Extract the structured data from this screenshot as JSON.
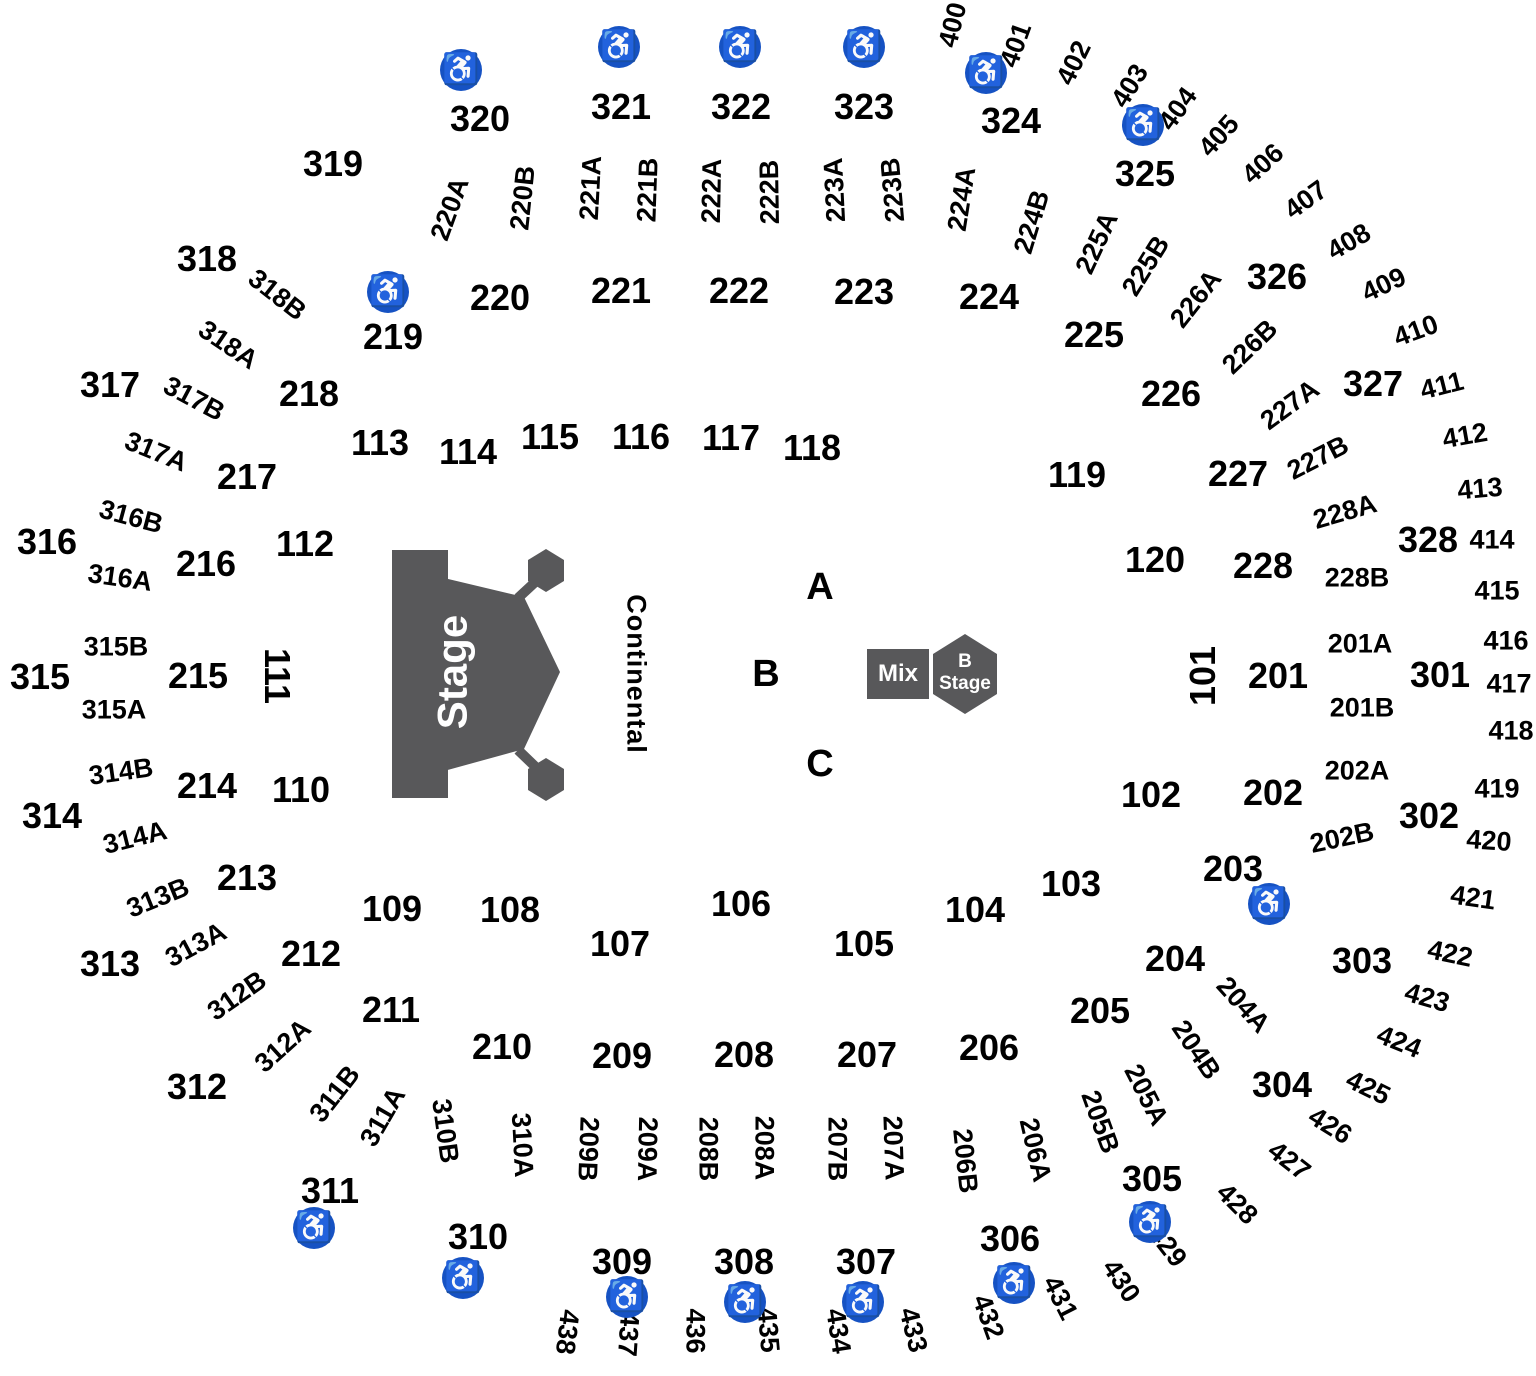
{
  "canvas": {
    "width": 1536,
    "height": 1376,
    "background": "#ffffff"
  },
  "colors": {
    "label_text": "#000000",
    "stage_fill": "#58585a",
    "stage_text": "#ffffff",
    "wheelchair_badge": "#1652c3",
    "wheelchair_glyph": "#ffffff"
  },
  "stage": {
    "label": "Stage"
  },
  "walkway": {
    "label": "Continental"
  },
  "mix_booth": {
    "label": "Mix"
  },
  "b_stage": {
    "line1": "B",
    "line2": "Stage"
  },
  "icons": {
    "wheelchair_glyph": "♿",
    "wheelchair_positions": [
      {
        "x": 461,
        "y": 70
      },
      {
        "x": 619,
        "y": 47
      },
      {
        "x": 740,
        "y": 47
      },
      {
        "x": 864,
        "y": 47
      },
      {
        "x": 986,
        "y": 73
      },
      {
        "x": 1143,
        "y": 125
      },
      {
        "x": 388,
        "y": 292
      },
      {
        "x": 1269,
        "y": 904
      },
      {
        "x": 314,
        "y": 1228
      },
      {
        "x": 463,
        "y": 1278
      },
      {
        "x": 627,
        "y": 1297
      },
      {
        "x": 745,
        "y": 1302
      },
      {
        "x": 863,
        "y": 1302
      },
      {
        "x": 1014,
        "y": 1283
      },
      {
        "x": 1150,
        "y": 1222
      }
    ]
  },
  "labels": {
    "floor_letters": [
      {
        "t": "A",
        "x": 820,
        "y": 587,
        "r": 0
      },
      {
        "t": "B",
        "x": 766,
        "y": 674,
        "r": 0
      },
      {
        "t": "C",
        "x": 820,
        "y": 764,
        "r": 0
      }
    ],
    "main": [
      {
        "t": "101",
        "x": 1203,
        "y": 676,
        "r": -90
      },
      {
        "t": "102",
        "x": 1151,
        "y": 795,
        "r": 0
      },
      {
        "t": "103",
        "x": 1071,
        "y": 884,
        "r": 0
      },
      {
        "t": "104",
        "x": 975,
        "y": 910,
        "r": 0
      },
      {
        "t": "105",
        "x": 864,
        "y": 944,
        "r": 0
      },
      {
        "t": "106",
        "x": 741,
        "y": 904,
        "r": 0
      },
      {
        "t": "107",
        "x": 620,
        "y": 944,
        "r": 0
      },
      {
        "t": "108",
        "x": 510,
        "y": 910,
        "r": 0
      },
      {
        "t": "109",
        "x": 392,
        "y": 909,
        "r": 0
      },
      {
        "t": "110",
        "x": 301,
        "y": 790,
        "r": 0
      },
      {
        "t": "111",
        "x": 277,
        "y": 676,
        "r": 90
      },
      {
        "t": "112",
        "x": 305,
        "y": 544,
        "r": 0
      },
      {
        "t": "113",
        "x": 380,
        "y": 443,
        "r": 0
      },
      {
        "t": "114",
        "x": 468,
        "y": 452,
        "r": 0
      },
      {
        "t": "115",
        "x": 550,
        "y": 437,
        "r": 0
      },
      {
        "t": "116",
        "x": 641,
        "y": 437,
        "r": 0
      },
      {
        "t": "117",
        "x": 731,
        "y": 438,
        "r": 0
      },
      {
        "t": "118",
        "x": 812,
        "y": 448,
        "r": 0
      },
      {
        "t": "119",
        "x": 1077,
        "y": 475,
        "r": 0
      },
      {
        "t": "120",
        "x": 1155,
        "y": 560,
        "r": 0
      },
      {
        "t": "201",
        "x": 1278,
        "y": 676,
        "r": 0
      },
      {
        "t": "202",
        "x": 1273,
        "y": 793,
        "r": 0
      },
      {
        "t": "203",
        "x": 1233,
        "y": 869,
        "r": 0
      },
      {
        "t": "204",
        "x": 1175,
        "y": 959,
        "r": 0
      },
      {
        "t": "205",
        "x": 1100,
        "y": 1011,
        "r": 0
      },
      {
        "t": "206",
        "x": 989,
        "y": 1048,
        "r": 0
      },
      {
        "t": "207",
        "x": 867,
        "y": 1055,
        "r": 0
      },
      {
        "t": "208",
        "x": 744,
        "y": 1055,
        "r": 0
      },
      {
        "t": "209",
        "x": 622,
        "y": 1056,
        "r": 0
      },
      {
        "t": "210",
        "x": 502,
        "y": 1047,
        "r": 0
      },
      {
        "t": "211",
        "x": 391,
        "y": 1010,
        "r": 0
      },
      {
        "t": "212",
        "x": 311,
        "y": 954,
        "r": 0
      },
      {
        "t": "213",
        "x": 247,
        "y": 878,
        "r": 0
      },
      {
        "t": "214",
        "x": 207,
        "y": 786,
        "r": 0
      },
      {
        "t": "215",
        "x": 198,
        "y": 676,
        "r": 0
      },
      {
        "t": "216",
        "x": 206,
        "y": 564,
        "r": 0
      },
      {
        "t": "217",
        "x": 247,
        "y": 477,
        "r": 0
      },
      {
        "t": "218",
        "x": 309,
        "y": 394,
        "r": 0
      },
      {
        "t": "219",
        "x": 393,
        "y": 337,
        "r": 0
      },
      {
        "t": "220",
        "x": 500,
        "y": 298,
        "r": 0
      },
      {
        "t": "221",
        "x": 621,
        "y": 291,
        "r": 0
      },
      {
        "t": "222",
        "x": 739,
        "y": 291,
        "r": 0
      },
      {
        "t": "223",
        "x": 864,
        "y": 292,
        "r": 0
      },
      {
        "t": "224",
        "x": 989,
        "y": 297,
        "r": 0
      },
      {
        "t": "225",
        "x": 1094,
        "y": 335,
        "r": 0
      },
      {
        "t": "226",
        "x": 1171,
        "y": 394,
        "r": 0
      },
      {
        "t": "227",
        "x": 1238,
        "y": 474,
        "r": 0
      },
      {
        "t": "228",
        "x": 1263,
        "y": 566,
        "r": 0
      },
      {
        "t": "301",
        "x": 1440,
        "y": 675,
        "r": 0
      },
      {
        "t": "302",
        "x": 1429,
        "y": 816,
        "r": 0
      },
      {
        "t": "303",
        "x": 1362,
        "y": 961,
        "r": 0
      },
      {
        "t": "304",
        "x": 1282,
        "y": 1085,
        "r": 0
      },
      {
        "t": "305",
        "x": 1152,
        "y": 1179,
        "r": 0
      },
      {
        "t": "306",
        "x": 1010,
        "y": 1239,
        "r": 0
      },
      {
        "t": "307",
        "x": 866,
        "y": 1262,
        "r": 0
      },
      {
        "t": "308",
        "x": 744,
        "y": 1262,
        "r": 0
      },
      {
        "t": "309",
        "x": 622,
        "y": 1262,
        "r": 0
      },
      {
        "t": "310",
        "x": 478,
        "y": 1237,
        "r": 0
      },
      {
        "t": "311",
        "x": 330,
        "y": 1191,
        "r": 0
      },
      {
        "t": "312",
        "x": 197,
        "y": 1087,
        "r": 0
      },
      {
        "t": "313",
        "x": 110,
        "y": 964,
        "r": 0
      },
      {
        "t": "314",
        "x": 52,
        "y": 816,
        "r": 0
      },
      {
        "t": "315",
        "x": 40,
        "y": 677,
        "r": 0
      },
      {
        "t": "316",
        "x": 47,
        "y": 542,
        "r": 0
      },
      {
        "t": "317",
        "x": 110,
        "y": 385,
        "r": 0
      },
      {
        "t": "318",
        "x": 207,
        "y": 259,
        "r": 0
      },
      {
        "t": "319",
        "x": 333,
        "y": 164,
        "r": 0
      },
      {
        "t": "320",
        "x": 480,
        "y": 119,
        "r": 0
      },
      {
        "t": "321",
        "x": 621,
        "y": 107,
        "r": 0
      },
      {
        "t": "322",
        "x": 741,
        "y": 107,
        "r": 0
      },
      {
        "t": "323",
        "x": 864,
        "y": 107,
        "r": 0
      },
      {
        "t": "324",
        "x": 1011,
        "y": 121,
        "r": 0
      },
      {
        "t": "325",
        "x": 1145,
        "y": 174,
        "r": 0
      },
      {
        "t": "326",
        "x": 1277,
        "y": 277,
        "r": 0
      },
      {
        "t": "327",
        "x": 1373,
        "y": 384,
        "r": 0
      },
      {
        "t": "328",
        "x": 1428,
        "y": 540,
        "r": 0
      }
    ],
    "sub": [
      {
        "t": "220A",
        "x": 450,
        "y": 209,
        "r": -70
      },
      {
        "t": "220B",
        "x": 523,
        "y": 198,
        "r": -84
      },
      {
        "t": "221A",
        "x": 591,
        "y": 188,
        "r": -87
      },
      {
        "t": "221B",
        "x": 648,
        "y": 190,
        "r": -88
      },
      {
        "t": "222A",
        "x": 712,
        "y": 191,
        "r": -89
      },
      {
        "t": "222B",
        "x": 770,
        "y": 192,
        "r": -91
      },
      {
        "t": "223A",
        "x": 835,
        "y": 190,
        "r": -93
      },
      {
        "t": "223B",
        "x": 893,
        "y": 190,
        "r": -95
      },
      {
        "t": "224A",
        "x": 962,
        "y": 199,
        "r": -81
      },
      {
        "t": "224B",
        "x": 1032,
        "y": 222,
        "r": -73
      },
      {
        "t": "225A",
        "x": 1097,
        "y": 243,
        "r": -65
      },
      {
        "t": "225B",
        "x": 1146,
        "y": 266,
        "r": -58
      },
      {
        "t": "226A",
        "x": 1196,
        "y": 299,
        "r": -52
      },
      {
        "t": "226B",
        "x": 1250,
        "y": 347,
        "r": -44
      },
      {
        "t": "227A",
        "x": 1290,
        "y": 405,
        "r": -36
      },
      {
        "t": "227B",
        "x": 1318,
        "y": 458,
        "r": -27
      },
      {
        "t": "228A",
        "x": 1345,
        "y": 512,
        "r": -16
      },
      {
        "t": "228B",
        "x": 1357,
        "y": 578,
        "r": 0
      },
      {
        "t": "201A",
        "x": 1360,
        "y": 644,
        "r": 0
      },
      {
        "t": "201B",
        "x": 1362,
        "y": 708,
        "r": 0
      },
      {
        "t": "202A",
        "x": 1357,
        "y": 771,
        "r": 0
      },
      {
        "t": "202B",
        "x": 1342,
        "y": 838,
        "r": -12
      },
      {
        "t": "204A",
        "x": 1243,
        "y": 1005,
        "r": 48
      },
      {
        "t": "204B",
        "x": 1196,
        "y": 1050,
        "r": 56
      },
      {
        "t": "205A",
        "x": 1146,
        "y": 1095,
        "r": 63
      },
      {
        "t": "205B",
        "x": 1100,
        "y": 1122,
        "r": 70
      },
      {
        "t": "206A",
        "x": 1035,
        "y": 1150,
        "r": 77
      },
      {
        "t": "206B",
        "x": 965,
        "y": 1161,
        "r": 84
      },
      {
        "t": "207A",
        "x": 893,
        "y": 1148,
        "r": 88
      },
      {
        "t": "207B",
        "x": 837,
        "y": 1149,
        "r": 90
      },
      {
        "t": "208A",
        "x": 764,
        "y": 1148,
        "r": 90
      },
      {
        "t": "208B",
        "x": 708,
        "y": 1149,
        "r": 90
      },
      {
        "t": "209A",
        "x": 647,
        "y": 1149,
        "r": 91
      },
      {
        "t": "209B",
        "x": 588,
        "y": 1149,
        "r": 92
      },
      {
        "t": "310A",
        "x": 522,
        "y": 1145,
        "r": 87
      },
      {
        "t": "310B",
        "x": 445,
        "y": 1131,
        "r": 82
      },
      {
        "t": "311A",
        "x": 383,
        "y": 1117,
        "r": -60
      },
      {
        "t": "311B",
        "x": 335,
        "y": 1094,
        "r": -52
      },
      {
        "t": "312A",
        "x": 283,
        "y": 1046,
        "r": -42
      },
      {
        "t": "312B",
        "x": 237,
        "y": 996,
        "r": -35
      },
      {
        "t": "313A",
        "x": 196,
        "y": 945,
        "r": -28
      },
      {
        "t": "313B",
        "x": 158,
        "y": 898,
        "r": -22
      },
      {
        "t": "314A",
        "x": 135,
        "y": 838,
        "r": -14
      },
      {
        "t": "314B",
        "x": 121,
        "y": 772,
        "r": -8
      },
      {
        "t": "315A",
        "x": 114,
        "y": 710,
        "r": 0
      },
      {
        "t": "315B",
        "x": 116,
        "y": 647,
        "r": 0
      },
      {
        "t": "316A",
        "x": 120,
        "y": 578,
        "r": 8
      },
      {
        "t": "316B",
        "x": 131,
        "y": 517,
        "r": 15
      },
      {
        "t": "317A",
        "x": 156,
        "y": 452,
        "r": 22
      },
      {
        "t": "317B",
        "x": 194,
        "y": 399,
        "r": 28
      },
      {
        "t": "318A",
        "x": 228,
        "y": 345,
        "r": 34
      },
      {
        "t": "318B",
        "x": 277,
        "y": 295,
        "r": 38
      }
    ],
    "upper": [
      {
        "t": "400",
        "x": 953,
        "y": 25,
        "r": -76
      },
      {
        "t": "401",
        "x": 1016,
        "y": 45,
        "r": -70
      },
      {
        "t": "402",
        "x": 1074,
        "y": 63,
        "r": -64
      },
      {
        "t": "403",
        "x": 1130,
        "y": 86,
        "r": -58
      },
      {
        "t": "404",
        "x": 1178,
        "y": 109,
        "r": -54
      },
      {
        "t": "405",
        "x": 1219,
        "y": 136,
        "r": -48
      },
      {
        "t": "406",
        "x": 1263,
        "y": 164,
        "r": -42
      },
      {
        "t": "407",
        "x": 1306,
        "y": 200,
        "r": -36
      },
      {
        "t": "408",
        "x": 1349,
        "y": 242,
        "r": -30
      },
      {
        "t": "409",
        "x": 1384,
        "y": 285,
        "r": -25
      },
      {
        "t": "410",
        "x": 1416,
        "y": 331,
        "r": -20
      },
      {
        "t": "411",
        "x": 1442,
        "y": 386,
        "r": -14
      },
      {
        "t": "412",
        "x": 1465,
        "y": 436,
        "r": -10
      },
      {
        "t": "413",
        "x": 1480,
        "y": 489,
        "r": -5
      },
      {
        "t": "414",
        "x": 1492,
        "y": 540,
        "r": 0
      },
      {
        "t": "415",
        "x": 1497,
        "y": 591,
        "r": 0
      },
      {
        "t": "416",
        "x": 1506,
        "y": 641,
        "r": 0
      },
      {
        "t": "417",
        "x": 1509,
        "y": 684,
        "r": 0
      },
      {
        "t": "418",
        "x": 1511,
        "y": 731,
        "r": 0
      },
      {
        "t": "419",
        "x": 1497,
        "y": 789,
        "r": 0
      },
      {
        "t": "420",
        "x": 1489,
        "y": 841,
        "r": 4
      },
      {
        "t": "421",
        "x": 1473,
        "y": 898,
        "r": 8
      },
      {
        "t": "422",
        "x": 1450,
        "y": 954,
        "r": 12
      },
      {
        "t": "423",
        "x": 1427,
        "y": 998,
        "r": 16
      },
      {
        "t": "424",
        "x": 1399,
        "y": 1042,
        "r": 22
      },
      {
        "t": "425",
        "x": 1368,
        "y": 1088,
        "r": 26
      },
      {
        "t": "426",
        "x": 1330,
        "y": 1126,
        "r": 32
      },
      {
        "t": "427",
        "x": 1289,
        "y": 1161,
        "r": 38
      },
      {
        "t": "428",
        "x": 1237,
        "y": 1204,
        "r": 45
      },
      {
        "t": "429",
        "x": 1167,
        "y": 1246,
        "r": 52
      },
      {
        "t": "430",
        "x": 1121,
        "y": 1281,
        "r": 56
      },
      {
        "t": "431",
        "x": 1060,
        "y": 1298,
        "r": 63
      },
      {
        "t": "432",
        "x": 988,
        "y": 1317,
        "r": 70
      },
      {
        "t": "433",
        "x": 913,
        "y": 1330,
        "r": 76
      },
      {
        "t": "434",
        "x": 838,
        "y": 1331,
        "r": 81
      },
      {
        "t": "435",
        "x": 768,
        "y": 1330,
        "r": 85
      },
      {
        "t": "436",
        "x": 695,
        "y": 1331,
        "r": 90
      },
      {
        "t": "437",
        "x": 628,
        "y": 1334,
        "r": 94
      },
      {
        "t": "438",
        "x": 567,
        "y": 1332,
        "r": 97
      }
    ]
  }
}
